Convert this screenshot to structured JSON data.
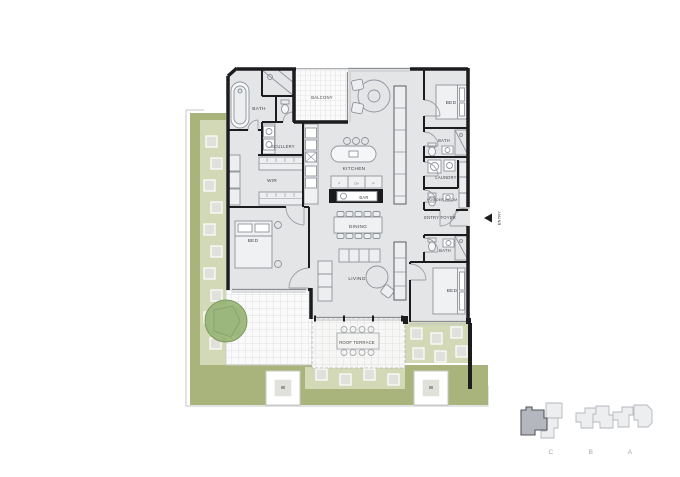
{
  "plan": {
    "rooms": {
      "bath_main": "BATH",
      "balcony": "BALCONY",
      "bed_top_right": "BED",
      "scullery": "SCULLERY",
      "kitchen": "KITCHEN",
      "wir": "WIR",
      "bath_right": "BATH",
      "laundry": "LAUNDRY",
      "powder_room": "POWDER ROOM",
      "bar": "BAR",
      "dining": "DINING",
      "entry_foyer": "ENTRY FOYER",
      "bed_left": "BED",
      "living": "LIVING",
      "bath_lower_right": "BATH",
      "bed_bottom_right": "BED",
      "roof_terrace": "ROOF TERRACE"
    },
    "kitchen_appliances": [
      "F",
      "OV",
      "P"
    ],
    "entry_label": "ENTRY"
  },
  "keyplan": {
    "buildings": [
      {
        "label": "C",
        "highlighted": true
      },
      {
        "label": "B",
        "highlighted": false
      },
      {
        "label": "A",
        "highlighted": false
      }
    ]
  },
  "colors": {
    "walls": "#1c1c1e",
    "room_fill": "#e4e5e7",
    "terrace_green": "#a9b47d",
    "terrace_green_light": "#d3d9b6",
    "planter_gray": "#dfe1da",
    "tree_green": "#93b06f",
    "keyplan_highlight": "#b4b7bd"
  }
}
